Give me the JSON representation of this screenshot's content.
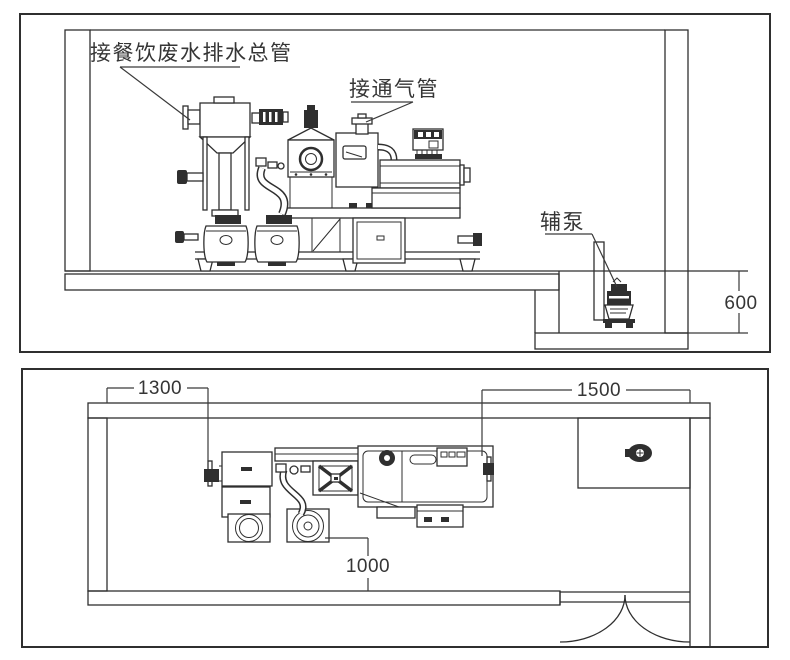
{
  "drawing": {
    "background": "#ffffff",
    "line_color": "#2f2f2f",
    "elevation_view": {
      "label_inlet_main": "接餐饮废水排水总管",
      "label_vent": "接通气管",
      "label_aux_pump": "辅泵",
      "dim_pit_depth": "600"
    },
    "plan_view": {
      "dim_left_offset": "1300",
      "dim_right_offset": "1500",
      "dim_front_clearance": "1000"
    }
  }
}
